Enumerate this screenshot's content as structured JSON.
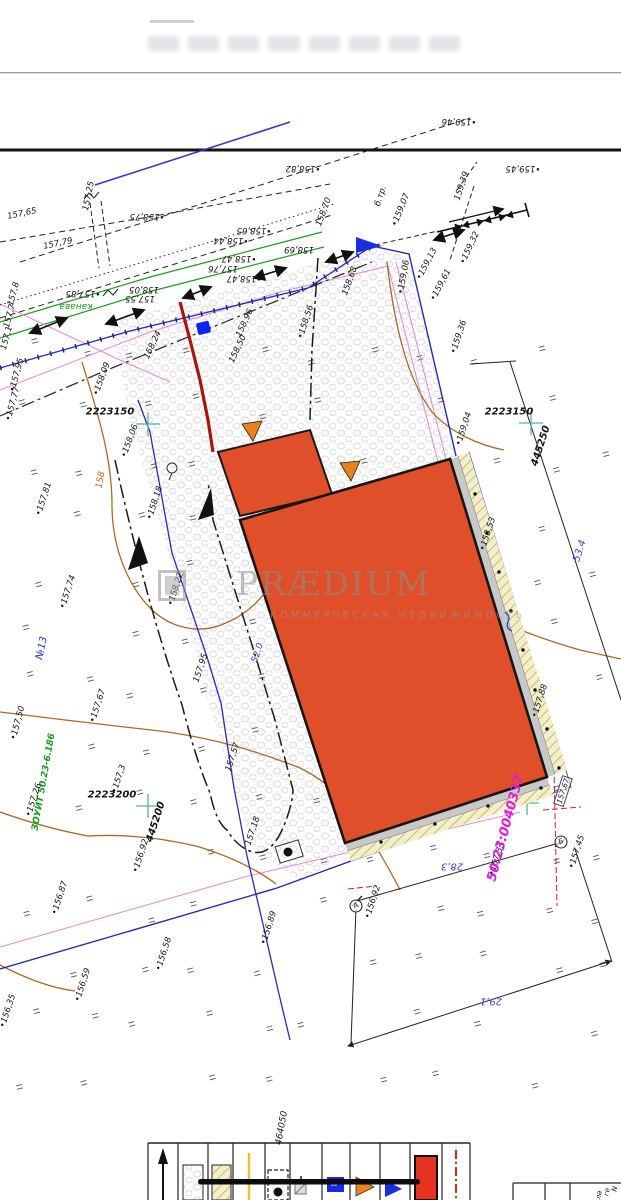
{
  "colors": {
    "label": "#141414",
    "green": "#17981c",
    "blue": "#2433c8",
    "dim": "#3a3ecb",
    "magenta": "#e21ae2",
    "brown": "#a86b28",
    "teal": "#58b0aa",
    "building_fill": "#de4f2a",
    "fence_blue": "#2828b0",
    "pink": "#e08ad8",
    "red_line": "#a81510",
    "accent_orange": "#e8831c"
  },
  "watermark": {
    "logo_icon": "praedium-logo",
    "title": "PRÆDIUM",
    "subtitle": "КОММЕРЧЕСКАЯ НЕДВИЖИМОСТЬ"
  },
  "legend": {
    "items": [
      "north-arrow",
      "gravel-surface-sample",
      "blind-area-hatch-sample",
      "yellow-line",
      "well-in-pit",
      "survey-marker",
      "blue-square-marker",
      "orange-entrance-triangle",
      "blue-entrance-triangle",
      "building-red-sample",
      "red-dash-dot-line"
    ]
  },
  "plan": {
    "labels": [
      {
        "t": "•159,46",
        "x": 459,
        "y": 121,
        "r": 180
      },
      {
        "t": "•158,82",
        "x": 303,
        "y": 168,
        "r": 180
      },
      {
        "t": "•159,45",
        "x": 523,
        "y": 168,
        "r": 180
      },
      {
        "t": "159,39",
        "x": 462,
        "y": 186,
        "r": -72
      },
      {
        "t": "157,25",
        "x": 89,
        "y": 196,
        "r": -78
      },
      {
        "t": "157,65",
        "x": 22,
        "y": 214,
        "r": -12
      },
      {
        "t": "157,79",
        "x": 58,
        "y": 244,
        "r": -12
      },
      {
        "t": "•158,75",
        "x": 147,
        "y": 216,
        "r": 180
      },
      {
        "t": "б.тр.",
        "x": 381,
        "y": 196,
        "r": -72
      },
      {
        "t": "•159,07",
        "x": 401,
        "y": 210,
        "r": -68
      },
      {
        "t": "158,70",
        "x": 324,
        "y": 212,
        "r": -70
      },
      {
        "t": "•159,32",
        "x": 470,
        "y": 248,
        "r": -65
      },
      {
        "t": "•159,13",
        "x": 427,
        "y": 264,
        "r": -62
      },
      {
        "t": "•159,61",
        "x": 441,
        "y": 285,
        "r": -62
      },
      {
        "t": "•159,06",
        "x": 404,
        "y": 277,
        "r": -80
      },
      {
        "t": "•158,44",
        "x": 231,
        "y": 240,
        "r": 180
      },
      {
        "t": "•158,65",
        "x": 254,
        "y": 230,
        "r": 180
      },
      {
        "t": "158,69",
        "x": 299,
        "y": 249,
        "r": 180
      },
      {
        "t": "•158,47",
        "x": 239,
        "y": 258,
        "r": 180
      },
      {
        "t": "157,76",
        "x": 223,
        "y": 268,
        "r": 180
      },
      {
        "t": "•158,47",
        "x": 244,
        "y": 278,
        "r": 180
      },
      {
        "t": "•157,85",
        "x": 83,
        "y": 293,
        "r": 180
      },
      {
        "t": "158,05",
        "x": 144,
        "y": 289,
        "r": 180
      },
      {
        "t": "157,55",
        "x": 140,
        "y": 298,
        "r": 180
      },
      {
        "t": "канава",
        "x": 76,
        "y": 306,
        "r": 180,
        "c": "green",
        "s": 9
      },
      {
        "t": "158,68",
        "x": 350,
        "y": 281,
        "r": -70
      },
      {
        "t": "•159,36",
        "x": 459,
        "y": 337,
        "r": -72
      },
      {
        "t": "•158,56",
        "x": 306,
        "y": 322,
        "r": -72
      },
      {
        "t": "158,24",
        "x": 153,
        "y": 345,
        "r": -65
      },
      {
        "t": "158,50",
        "x": 238,
        "y": 349,
        "r": -65
      },
      {
        "t": "158,96",
        "x": 245,
        "y": 323,
        "r": -65
      },
      {
        "t": "157,8",
        "x": 14,
        "y": 294,
        "r": -75
      },
      {
        "t": "157,7",
        "x": 10,
        "y": 316,
        "r": -75
      },
      {
        "t": "157,1",
        "x": 7,
        "y": 338,
        "r": -75
      },
      {
        "t": "•157,95",
        "x": 17,
        "y": 375,
        "r": -75
      },
      {
        "t": "•157,77",
        "x": 13,
        "y": 404,
        "r": -75
      },
      {
        "t": "•158,09",
        "x": 102,
        "y": 379,
        "r": -70
      },
      {
        "t": "2223150",
        "x": 110,
        "y": 412,
        "r": 0,
        "s": 10,
        "b": true
      },
      {
        "t": "2223150",
        "x": 509,
        "y": 412,
        "r": 0,
        "s": 10,
        "b": true
      },
      {
        "t": "445250",
        "x": 541,
        "y": 446,
        "r": -72,
        "s": 10,
        "b": true
      },
      {
        "t": "•158,06",
        "x": 130,
        "y": 441,
        "r": -70
      },
      {
        "t": "158",
        "x": 101,
        "y": 480,
        "r": -80,
        "c": "brown",
        "s": 9
      },
      {
        "t": "•157,81",
        "x": 44,
        "y": 499,
        "r": -72
      },
      {
        "t": "•158,18",
        "x": 155,
        "y": 503,
        "r": -72
      },
      {
        "t": "•157,74",
        "x": 68,
        "y": 592,
        "r": -72
      },
      {
        "t": "•158,22",
        "x": 176,
        "y": 589,
        "r": -72
      },
      {
        "t": "№13",
        "x": 42,
        "y": 648,
        "r": -78,
        "c": "blue",
        "s": 10
      },
      {
        "t": "ЗОУИТ 50.23-6.186",
        "x": 44,
        "y": 782,
        "r": -80,
        "c": "green",
        "s": 9,
        "b": true
      },
      {
        "t": "•157,50",
        "x": 18,
        "y": 723,
        "r": -75
      },
      {
        "t": "•157,67",
        "x": 98,
        "y": 706,
        "r": -72
      },
      {
        "t": "157,95",
        "x": 201,
        "y": 668,
        "r": -72
      },
      {
        "t": "•157,26",
        "x": 34,
        "y": 800,
        "r": -72
      },
      {
        "t": "•157,3",
        "x": 119,
        "y": 779,
        "r": -72
      },
      {
        "t": "2223200",
        "x": 112,
        "y": 795,
        "r": 0,
        "s": 10,
        "b": true
      },
      {
        "t": "445200",
        "x": 156,
        "y": 822,
        "r": -72,
        "s": 10,
        "b": true
      },
      {
        "t": "•156,92",
        "x": 141,
        "y": 856,
        "r": -72
      },
      {
        "t": "•156,87",
        "x": 60,
        "y": 898,
        "r": -72
      },
      {
        "t": "•156,89",
        "x": 269,
        "y": 928,
        "r": -72
      },
      {
        "t": "•156,58",
        "x": 164,
        "y": 954,
        "r": -72
      },
      {
        "t": "•156,59",
        "x": 83,
        "y": 985,
        "r": -72
      },
      {
        "t": "•156,35",
        "x": 8,
        "y": 1011,
        "r": -72
      },
      {
        "t": "157,57",
        "x": 233,
        "y": 757,
        "r": -72
      },
      {
        "t": "157,18",
        "x": 253,
        "y": 831,
        "r": -72
      },
      {
        "t": "52.0",
        "x": 258,
        "y": 653,
        "r": -72,
        "c": "dim",
        "s": 9
      },
      {
        "t": "•159,04",
        "x": 464,
        "y": 429,
        "r": -72
      },
      {
        "t": "•158,53",
        "x": 488,
        "y": 534,
        "r": -72
      },
      {
        "t": "•157,88",
        "x": 540,
        "y": 701,
        "r": -72
      },
      {
        "t": "157,67",
        "x": 563,
        "y": 791,
        "r": -72,
        "box": true,
        "s": 7.5
      },
      {
        "t": "•157,45",
        "x": 577,
        "y": 852,
        "r": -72
      },
      {
        "t": "•157,33",
        "x": 497,
        "y": 859,
        "r": -72
      },
      {
        "t": "•156,92",
        "x": 373,
        "y": 902,
        "r": -72
      },
      {
        "t": "28,3",
        "x": 452,
        "y": 866,
        "r": 180,
        "c": "dim",
        "s": 10
      },
      {
        "t": "29,1",
        "x": 491,
        "y": 1001,
        "r": 180,
        "c": "dim",
        "s": 10
      },
      {
        "t": "53.4",
        "x": 580,
        "y": 551,
        "r": -72,
        "c": "dim",
        "s": 10
      },
      {
        "t": "50:23:0040337",
        "x": 506,
        "y": 828,
        "r": -75,
        "c": "magenta",
        "s": 13,
        "b": true
      },
      {
        "t": "464050",
        "x": 282,
        "y": 1128,
        "r": -80,
        "s": 9
      },
      {
        "t": "А",
        "x": 356,
        "y": 906,
        "r": -15,
        "circ": true,
        "s": 7
      },
      {
        "t": "Б",
        "x": 561,
        "y": 842,
        "r": -15,
        "circ": true,
        "s": 7
      },
      {
        "t": "N",
        "x": 615,
        "y": 1189,
        "r": -80,
        "s": 7
      },
      {
        "t": "ге",
        "x": 607,
        "y": 1192,
        "r": -80,
        "s": 7
      },
      {
        "t": "ла",
        "x": 599,
        "y": 1195,
        "r": -80,
        "s": 7
      }
    ]
  }
}
